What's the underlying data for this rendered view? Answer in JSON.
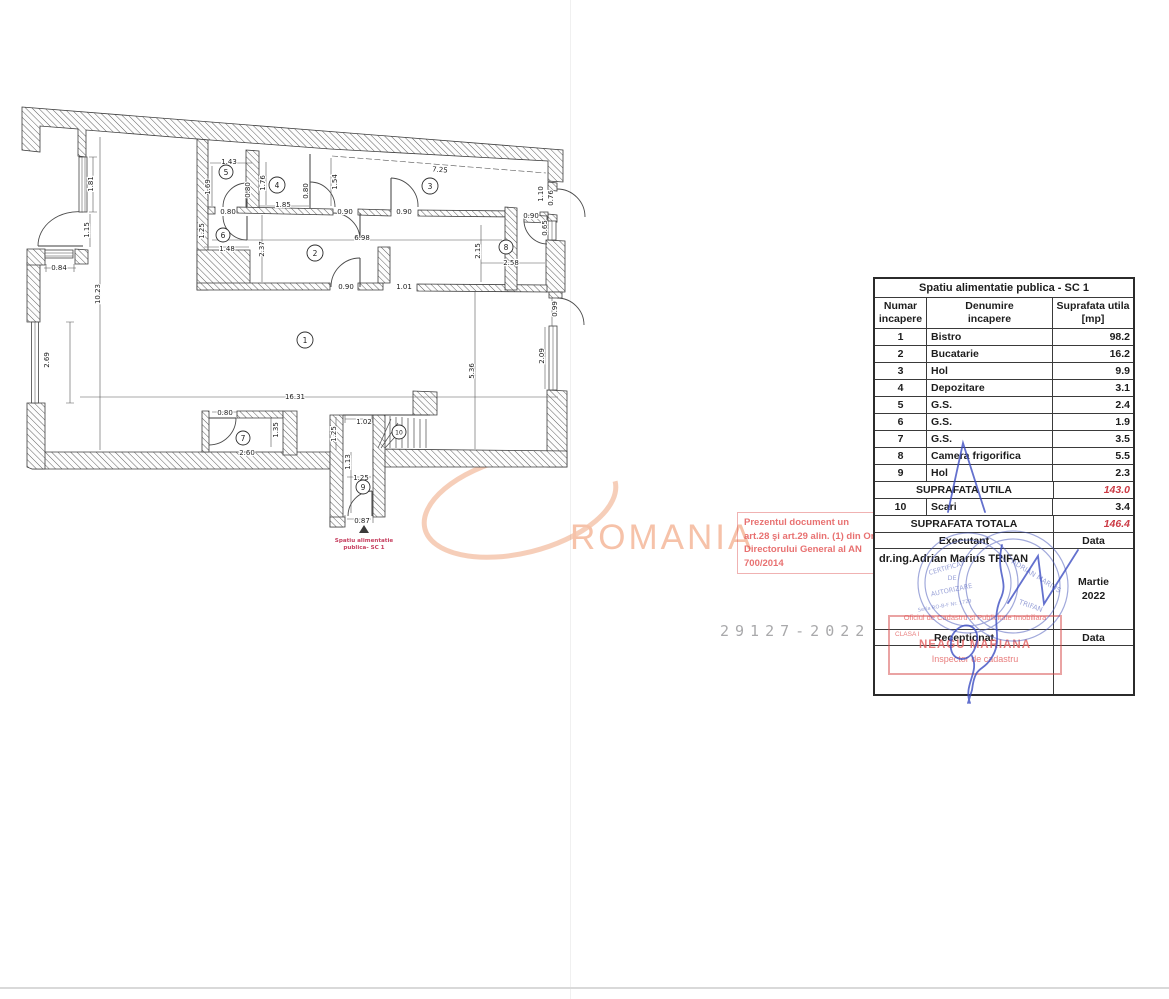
{
  "page": {
    "doc_number": "29127-2022"
  },
  "watermark": {
    "text": "ROMANIA"
  },
  "red_note": {
    "lines": [
      "Prezentul document un",
      "art.28 şi art.29 alin. (1) din Or",
      "Directorului General al AN",
      "700/2014"
    ]
  },
  "plan": {
    "dims": [
      "1.81",
      "1.15",
      "0.84",
      "2.69",
      "10.23",
      "16.31",
      "1.43",
      "1.69",
      "0.80",
      "1.76",
      "1.85",
      "0.80",
      "1.54",
      "7.25",
      "0.80",
      "0.90",
      "0.90",
      "0.90",
      "1.10",
      "0.76",
      "0.65",
      "1.25",
      "1.48",
      "2.37",
      "6.98",
      "2.15",
      "2.58",
      "0.90",
      "1.01",
      "0.99",
      "2.09",
      "5.36",
      "0.80",
      "1.35",
      "2.60",
      "1.02",
      "1.25",
      "1.13",
      "1.25",
      "0.87"
    ],
    "rooms": [
      "1",
      "2",
      "3",
      "4",
      "5",
      "6",
      "7",
      "8",
      "9",
      "10"
    ],
    "label": {
      "line1": "Spatiu alimentatie",
      "line2": "publica- SC 1"
    }
  },
  "table": {
    "title": "Spatiu alimentatie publica - SC 1",
    "headers": {
      "col1_line1": "Numar",
      "col1_line2": "incapere",
      "col2_line1": "Denumire",
      "col2_line2": "incapere",
      "col3_line1": "Suprafata utila",
      "col3_line2": "[mp]"
    },
    "rows": [
      {
        "nr": "1",
        "name": "Bistro",
        "area": "98.2"
      },
      {
        "nr": "2",
        "name": "Bucatarie",
        "area": "16.2"
      },
      {
        "nr": "3",
        "name": "Hol",
        "area": "9.9"
      },
      {
        "nr": "4",
        "name": "Depozitare",
        "area": "3.1"
      },
      {
        "nr": "5",
        "name": "G.S.",
        "area": "2.4"
      },
      {
        "nr": "6",
        "name": "G.S.",
        "area": "1.9"
      },
      {
        "nr": "7",
        "name": "G.S.",
        "area": "3.5"
      },
      {
        "nr": "8",
        "name": "Camera frigorifica",
        "area": "5.5"
      },
      {
        "nr": "9",
        "name": "Hol",
        "area": "2.3"
      }
    ],
    "subtotal": {
      "label": "SUPRAFATA UTILA",
      "value": "143.0"
    },
    "row10": {
      "nr": "10",
      "name": "Scari",
      "area": "3.4"
    },
    "total": {
      "label": "SUPRAFATA TOTALA",
      "value": "146.4"
    },
    "executant": {
      "label": "Executant",
      "data_label": "Data",
      "name": "dr.ing.Adrian Marius TRIFAN",
      "month": "Martie",
      "year": "2022"
    },
    "receptionat": {
      "label": "Receptionat",
      "data_label": "Data"
    }
  },
  "stamps": {
    "blue": {
      "line1": "CERTIFICAT",
      "line2": "DE",
      "line3": "AUTORIZARE",
      "seria": "Seria RO-B-F Nr. 1729",
      "name": "ADRIAN MARIUS",
      "name2": "TRIFAN"
    },
    "red": {
      "office": "Oficiul de Cadastru si Publicitate Imobiliara",
      "clasa": "CLASA I",
      "name": "NEAGU MARIANA",
      "role": "Inspector de cadastru"
    }
  }
}
